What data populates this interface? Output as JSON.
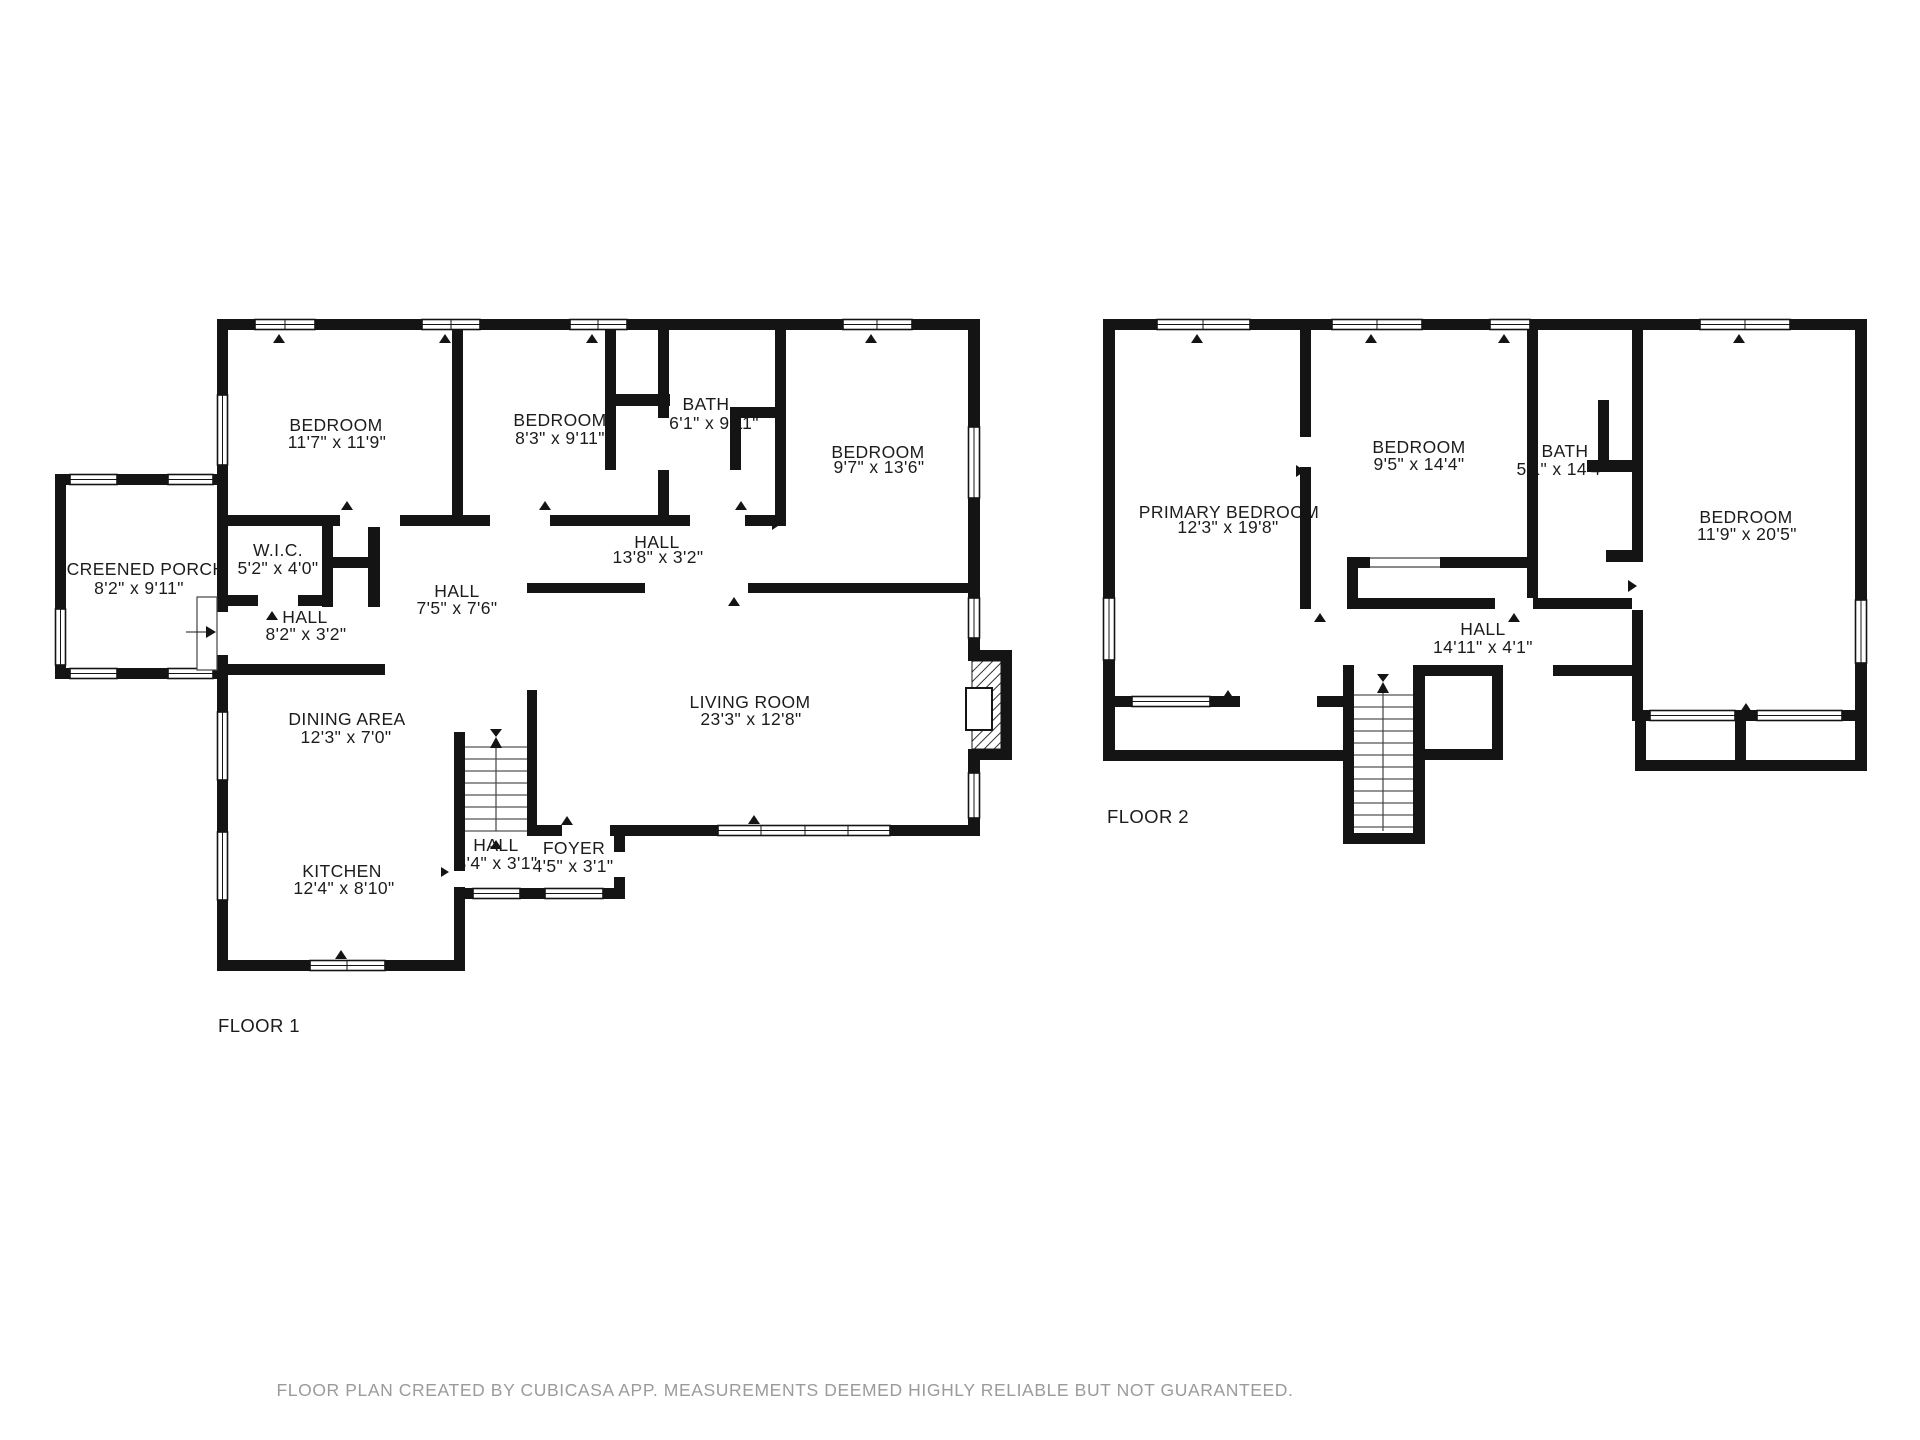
{
  "meta": {
    "wall_color": "#141414",
    "text_color": "#1c1c1c",
    "footer_color": "#9b9b9b",
    "background": "#ffffff",
    "app": "CubiCasa"
  },
  "footer": {
    "text": "FLOOR PLAN CREATED BY CUBICASA APP. MEASUREMENTS DEEMED HIGHLY RELIABLE BUT NOT GUARANTEED."
  },
  "floor1": {
    "label": "FLOOR 1",
    "rooms": [
      {
        "name": "SCREENED PORCH",
        "dims": "8'2\" x 9'11\""
      },
      {
        "name": "BEDROOM",
        "dims": "11'7\" x 11'9\""
      },
      {
        "name": "BEDROOM",
        "dims": "8'3\" x 9'11\""
      },
      {
        "name": "BATH",
        "dims": "6'1\" x 9'11\""
      },
      {
        "name": "BEDROOM",
        "dims": "9'7\" x 13'6\""
      },
      {
        "name": "W.I.C.",
        "dims": "5'2\" x 4'0\""
      },
      {
        "name": "HALL",
        "dims": "13'8\" x 3'2\""
      },
      {
        "name": "HALL",
        "dims": "7'5\" x 7'6\""
      },
      {
        "name": "HALL",
        "dims": "8'2\" x 3'2\""
      },
      {
        "name": "DINING AREA",
        "dims": "12'3\" x 7'0\""
      },
      {
        "name": "LIVING ROOM",
        "dims": "23'3\" x 12'8\""
      },
      {
        "name": "KITCHEN",
        "dims": "12'4\" x 8'10\""
      },
      {
        "name": "HALL",
        "dims": "3'4\" x 3'1\""
      },
      {
        "name": "FOYER",
        "dims": "4'5\" x 3'1\""
      }
    ]
  },
  "floor2": {
    "label": "FLOOR 2",
    "rooms": [
      {
        "name": "PRIMARY BEDROOM",
        "dims": "12'3\" x 19'8\""
      },
      {
        "name": "BEDROOM",
        "dims": "9'5\" x 14'4\""
      },
      {
        "name": "BATH",
        "dims": "5'1\" x 14'4\""
      },
      {
        "name": "BEDROOM",
        "dims": "11'9\" x 20'5\""
      },
      {
        "name": "HALL",
        "dims": "14'11\" x 4'1\""
      }
    ]
  }
}
